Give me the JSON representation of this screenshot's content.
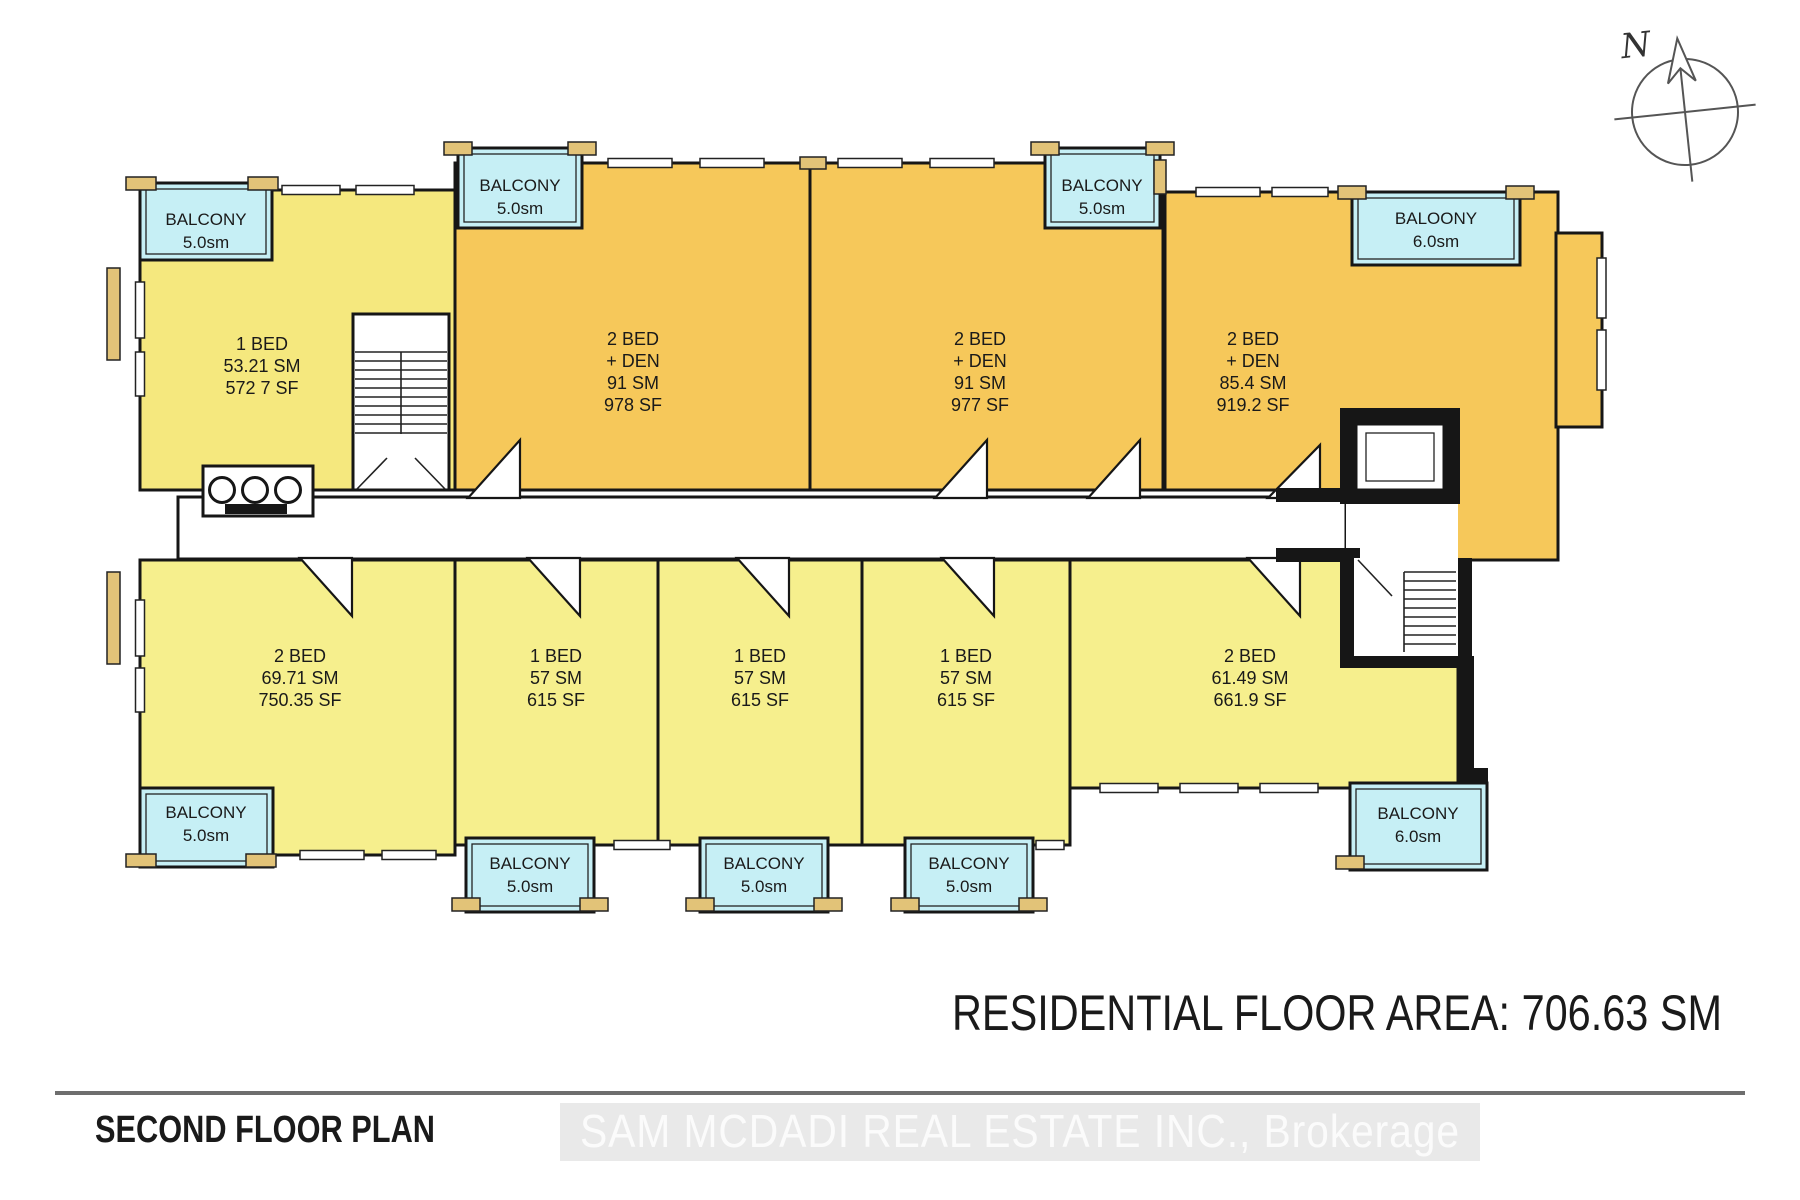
{
  "plan": {
    "title": "SECOND FLOOR PLAN",
    "area_note": "RESIDENTIAL FLOOR AREA: 706.63 SM",
    "watermark": "SAM MCDADI REAL ESTATE INC., Brokerage",
    "compass_label": "N"
  },
  "colors": {
    "unit_light_top": "#F5E87E",
    "unit_light_bottom": "#F6EF8D",
    "unit_orange": "#F6C85A",
    "balcony": "#C6EFF5",
    "trim": "#E2C378",
    "wall": "#161616",
    "watermark_bg": "#e9e9e9",
    "watermark_text": "#fbfbfb"
  },
  "units": [
    {
      "name": "unit-1-bed-top-left",
      "lines": [
        "1 BED",
        "53.21 SM",
        "572 7 SF"
      ]
    },
    {
      "name": "unit-2-bed-den-a",
      "lines": [
        "2 BED",
        "+ DEN",
        "91 SM",
        "978 SF"
      ]
    },
    {
      "name": "unit-2-bed-den-b",
      "lines": [
        "2 BED",
        "+ DEN",
        "91 SM",
        "977 SF"
      ]
    },
    {
      "name": "unit-2-bed-den-c",
      "lines": [
        "2 BED",
        "+ DEN",
        "85.4 SM",
        "919.2 SF"
      ]
    },
    {
      "name": "unit-2-bed-bottom-left",
      "lines": [
        "2 BED",
        "69.71 SM",
        "750.35 SF"
      ]
    },
    {
      "name": "unit-1-bed-bottom-a",
      "lines": [
        "1 BED",
        "57 SM",
        "615 SF"
      ]
    },
    {
      "name": "unit-1-bed-bottom-b",
      "lines": [
        "1 BED",
        "57 SM",
        "615 SF"
      ]
    },
    {
      "name": "unit-1-bed-bottom-c",
      "lines": [
        "1 BED",
        "57 SM",
        "615 SF"
      ]
    },
    {
      "name": "unit-2-bed-bottom-right",
      "lines": [
        "2 BED",
        "61.49 SM",
        "661.9 SF"
      ]
    }
  ],
  "balconies": [
    {
      "label": "BALCONY",
      "size": "5.0sm"
    },
    {
      "label": "BALCONY",
      "size": "5.0sm"
    },
    {
      "label": "BALCONY",
      "size": "5.0sm"
    },
    {
      "label": "BALOONY",
      "size": "6.0sm"
    },
    {
      "label": "BALCONY",
      "size": "5.0sm"
    },
    {
      "label": "BALCONY",
      "size": "5.0sm"
    },
    {
      "label": "BALCONY",
      "size": "5.0sm"
    },
    {
      "label": "BALCONY",
      "size": "5.0sm"
    },
    {
      "label": "BALCONY",
      "size": "6.0sm"
    }
  ]
}
